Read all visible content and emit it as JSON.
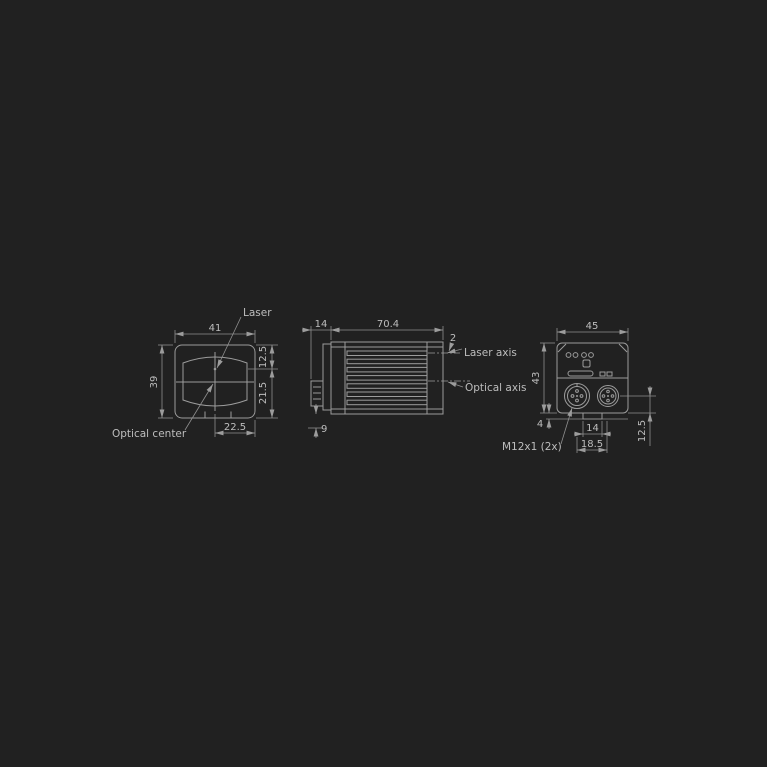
{
  "drawing": {
    "type": "dimensioned technical drawing, three views of a laser sensor",
    "colors": {
      "background": "#212121",
      "line": "#9c9c9c",
      "text": "#bdbdbd"
    },
    "front_view": {
      "label_laser": "Laser",
      "label_optical_center": "Optical center",
      "dim_width": "41",
      "dim_height": "39",
      "dim_top_to_laser": "12.5",
      "dim_laser_to_bottom": "21.5",
      "dim_bottom_offset": "22.5"
    },
    "side_view": {
      "label_laser_axis": "Laser axis",
      "label_optical_axis": "Optical axis",
      "dim_front_depth": "14",
      "dim_body_length": "70.4",
      "dim_laser_offset": "2",
      "dim_bottom_depth": "9"
    },
    "rear_view": {
      "label_connectors": "M12x1 (2x)",
      "dim_width": "45",
      "dim_height": "43",
      "dim_foot": "4",
      "dim_tab_width": "14",
      "dim_connector_spacing": "18.5",
      "dim_connector_to_bottom": "12.5"
    }
  }
}
